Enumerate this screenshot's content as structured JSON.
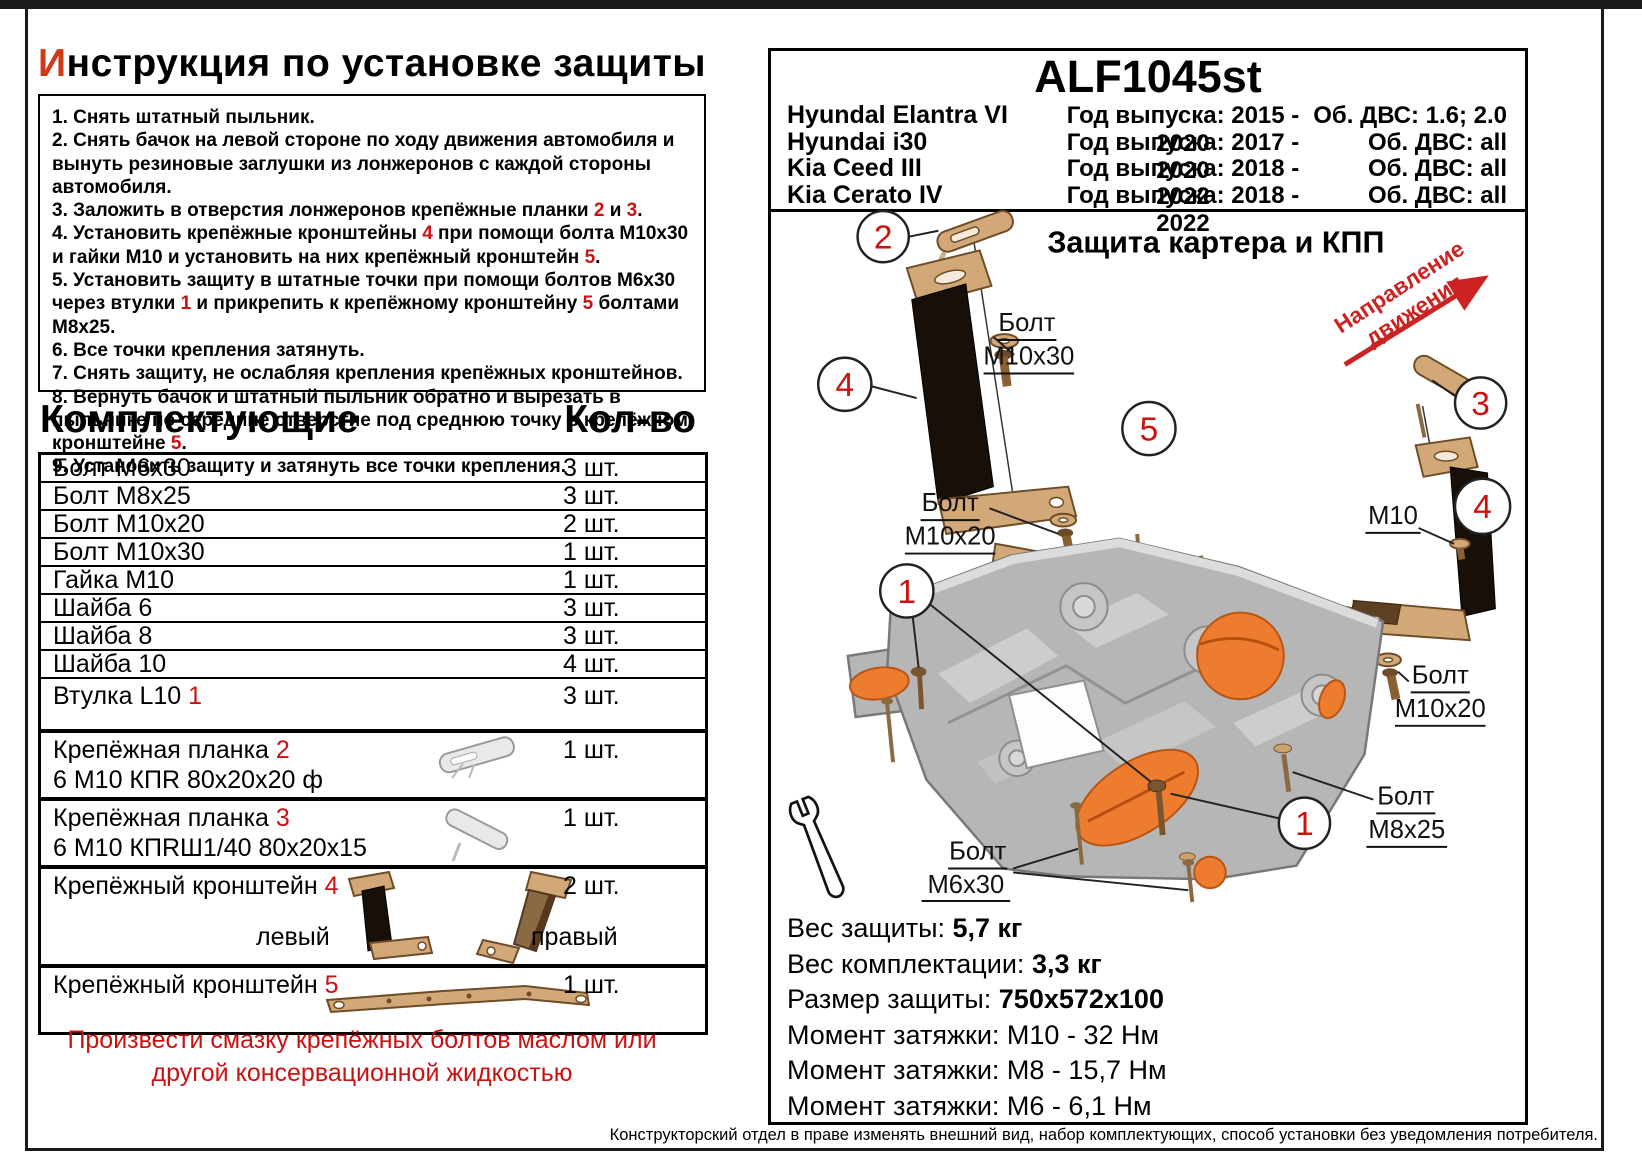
{
  "colors": {
    "accent_red": "#cc1111",
    "title_red": "#cf3a18",
    "tan": "#d3a878",
    "orange": "#ed7c2f",
    "plate_gray": "#b6b6b6"
  },
  "left": {
    "title": {
      "head": "И",
      "rest": "нструкция по установке защиты"
    },
    "instructions": [
      [
        {
          "t": "1. Снять штатный пыльник."
        }
      ],
      [
        {
          "t": "2. Снять бачок на левой стороне по ходу движения автомобиля и вынуть резиновые заглушки из лонжеронов с каждой стороны автомобиля."
        }
      ],
      [
        {
          "t": "3. Заложить в отверстия лонжеронов крепёжные планки "
        },
        {
          "r": "2"
        },
        {
          "t": " и "
        },
        {
          "r": "3"
        },
        {
          "t": "."
        }
      ],
      [
        {
          "t": "4. Установить крепёжные кронштейны "
        },
        {
          "r": "4"
        },
        {
          "t": " при помощи болта М10х30 и гайки М10 и установить на них крепёжный кронштейн "
        },
        {
          "r": "5"
        },
        {
          "t": "."
        }
      ],
      [
        {
          "t": "5. Установить защиту в штатные точки при помощи болтов М6х30 через втулки "
        },
        {
          "r": "1"
        },
        {
          "t": " и прикрепить к крепёжному кронштейну "
        },
        {
          "r": "5"
        },
        {
          "t": " болтами М8х25."
        }
      ],
      [
        {
          "t": "6. Все точки крепления затянуть."
        }
      ],
      [
        {
          "t": "7. Снять защиту, не ослабляя крепления крепёжных кронштейнов."
        }
      ],
      [
        {
          "t": "8. Вернуть бачок и штатный пыльник обратно и вырезать в пыльнике по середине отверстие под среднюю точку в крепёжном кронштейне "
        },
        {
          "r": "5"
        },
        {
          "t": "."
        }
      ],
      [
        {
          "t": "9. Установить защиту и затянуть все точки крепления."
        }
      ]
    ],
    "parts_header": {
      "name": "Комплектующие",
      "qty": "Кол-во"
    },
    "parts": [
      {
        "cls": "r-s",
        "name": [
          {
            "t": "Болт М6х30"
          }
        ],
        "qty": "3 шт."
      },
      {
        "cls": "r-s",
        "name": [
          {
            "t": "Болт М8х25"
          }
        ],
        "qty": "3 шт."
      },
      {
        "cls": "r-s",
        "name": [
          {
            "t": "Болт М10х20"
          }
        ],
        "qty": "2 шт."
      },
      {
        "cls": "r-s",
        "name": [
          {
            "t": "Болт М10х30"
          }
        ],
        "qty": "1 шт."
      },
      {
        "cls": "r-s",
        "name": [
          {
            "t": "Гайка М10"
          }
        ],
        "qty": "1 шт."
      },
      {
        "cls": "r-s",
        "name": [
          {
            "t": "Шайба 6"
          }
        ],
        "qty": "3 шт."
      },
      {
        "cls": "r-s",
        "name": [
          {
            "t": "Шайба 8"
          }
        ],
        "qty": "3 шт."
      },
      {
        "cls": "r-s",
        "name": [
          {
            "t": "Шайба 10"
          }
        ],
        "qty": "4 шт."
      },
      {
        "cls": "r-m",
        "name": [
          {
            "t": "Втулка L10 "
          },
          {
            "r": "1"
          }
        ],
        "qty": "3 шт."
      },
      {
        "cls": "r-l grp",
        "name": [
          {
            "t": "Крепёжная планка "
          },
          {
            "r": "2"
          }
        ],
        "name2": "6 М10 КПR 80х20х20 ф",
        "qty": "1 шт.",
        "img": "plank2"
      },
      {
        "cls": "r-l grp",
        "name": [
          {
            "t": "Крепёжная планка "
          },
          {
            "r": "3"
          }
        ],
        "name2": "6 М10 КПRШ1/40 80х20х15",
        "qty": "1 шт.",
        "img": "plank3"
      },
      {
        "cls": "r-xl grp",
        "name": [
          {
            "t": "Крепёжный кронштейн "
          },
          {
            "r": "4"
          }
        ],
        "qty": "2 шт.",
        "img": "bracket4",
        "left_label": "левый",
        "right_label": "правый"
      },
      {
        "cls": "r-l grp",
        "name": [
          {
            "t": "Крепёжный кронштейн "
          },
          {
            "r": "5"
          }
        ],
        "qty": "1 шт.",
        "img": "bracket5"
      }
    ],
    "note": "Произвести смазку крепёжных болтов маслом или другой консервационной жидкостью"
  },
  "right": {
    "code": "ALF1045st",
    "models": [
      {
        "name": "Hyundal Elantra VI",
        "years": "Год выпуска: 2015 - 2020",
        "engine": "Об. ДВС: 1.6; 2.0"
      },
      {
        "name": "Hyundai i30",
        "years": "Год выпуска: 2017 - 2020",
        "engine": "Об. ДВС: all"
      },
      {
        "name": "Kia Ceed III",
        "years": "Год выпуска: 2018 - 2022",
        "engine": "Об. ДВС: all"
      },
      {
        "name": "Kia Cerato IV",
        "years": "Год выпуска: 2018 - 2022",
        "engine": "Об. ДВС: all"
      }
    ],
    "diagram": {
      "title": "Защита картера и КПП",
      "direction_line1": "Направление",
      "direction_line2": "движения",
      "callouts": {
        "n1": "1",
        "n2": "2",
        "n3": "3",
        "n4": "4",
        "n5": "5"
      },
      "labels": {
        "bolt": "Болт",
        "m10x30": "М10х30",
        "m10x20": "М10х20",
        "m10": "М10",
        "m8x25": "М8х25",
        "m6x30": "М6х30"
      }
    },
    "specs": [
      {
        "label": "Вес защиты:",
        "value": "5,7 кг",
        "bold": true
      },
      {
        "label": "Вес комплектации:",
        "value": "3,3 кг",
        "bold": true
      },
      {
        "label": "Размер защиты:",
        "value": "750х572х100",
        "bold": true
      },
      {
        "label": "Момент затяжки:",
        "value": "М10 - 32 Нм",
        "bold": false
      },
      {
        "label": "Момент затяжки:",
        "value": "М8 - 15,7 Нм",
        "bold": false
      },
      {
        "label": "Момент затяжки:",
        "value": "М6 - 6,1 Нм",
        "bold": false
      }
    ],
    "disclaimer": "Конструкторский отдел в праве изменять внешний вид, набор комплектующих, способ установки без уведомления потребителя."
  }
}
